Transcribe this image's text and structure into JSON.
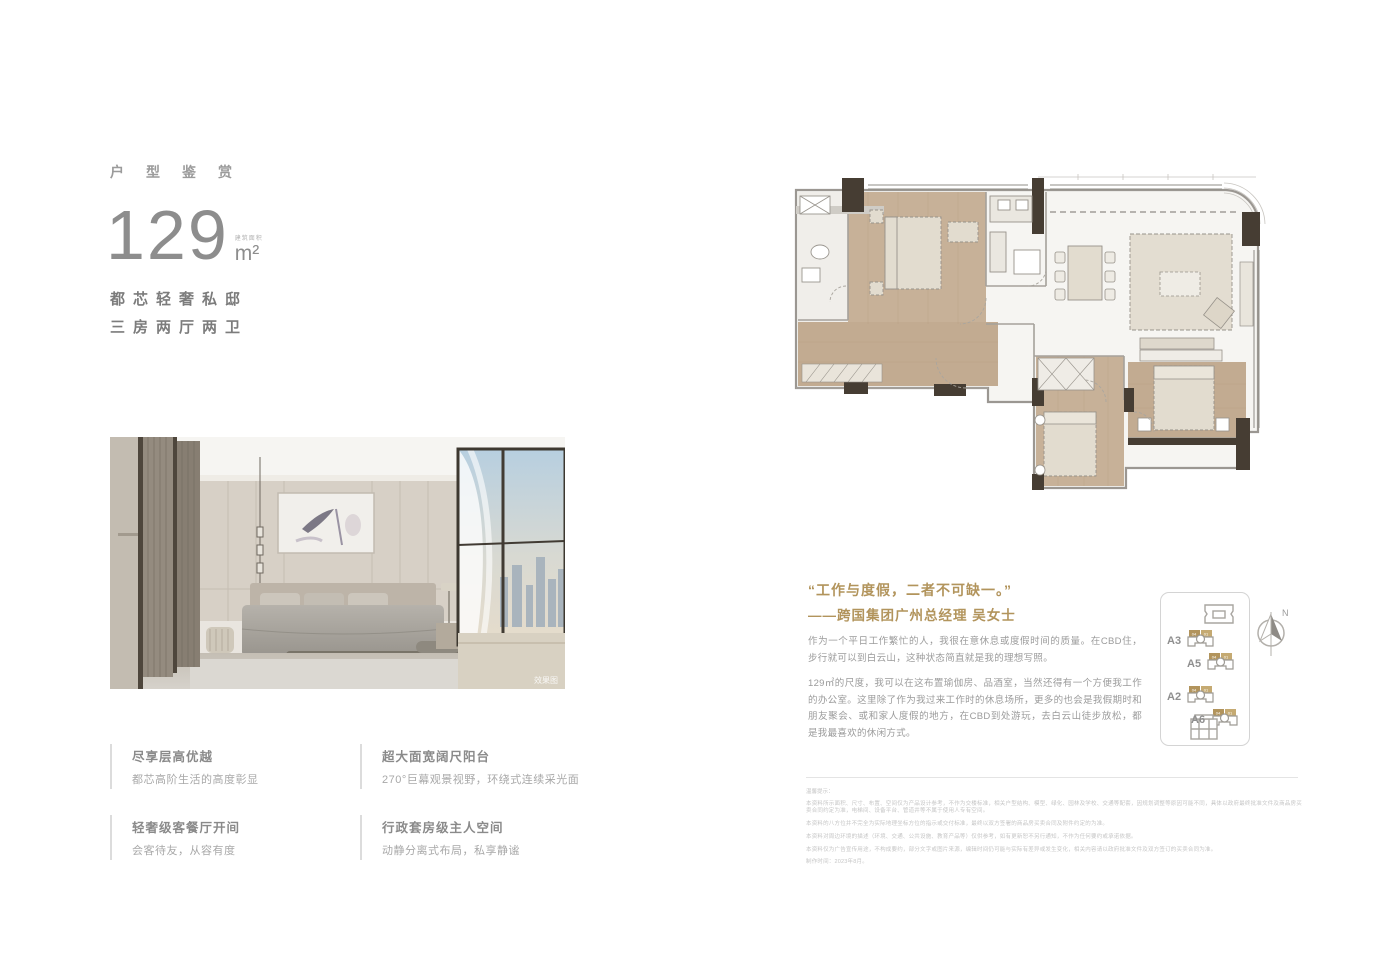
{
  "colors": {
    "gold": "#b2945c",
    "heading_gray": "#7c7c7c",
    "body_gray": "#9b9b9b",
    "disclaimer_gray": "#c6c6c6",
    "wood_floor": "#c7b198",
    "wall_dark": "#463d33"
  },
  "header": {
    "eyebrow": "户型鉴赏"
  },
  "area": {
    "number": "129",
    "label": "建筑面积",
    "unit": "m²"
  },
  "taglines": {
    "line1": "都芯轻奢私邸",
    "line2": "三房两厅两卫"
  },
  "photo": {
    "watermark": "效果图"
  },
  "features": [
    {
      "title": "尽享层高优越",
      "desc": "都芯高阶生活的高度彰显"
    },
    {
      "title": "超大面宽阔尺阳台",
      "desc": "270°巨幕观景视野，环绕式连续采光面"
    },
    {
      "title": "轻奢级客餐厅开间",
      "desc": "会客待友，从容有度"
    },
    {
      "title": "行政套房级主人空间",
      "desc": "动静分离式布局，私享静谧"
    }
  ],
  "quote": {
    "line1": "“工作与度假，二者不可缺一。”",
    "line2": "——跨国集团广州总经理 吴女士"
  },
  "paragraphs": {
    "p1": "作为一个平日工作繁忙的人，我很在意休息或度假时间的质量。在CBD住，步行就可以到白云山，这种状态简直就是我的理想写照。",
    "p2": "129㎡的尺度，我可以在这布置瑜伽房、品酒室，当然还得有一个方便我工作的办公室。这里除了作为我过来工作时的休息场所，更多的也会是我假期时和朋友聚会、或和家人度假的地方，在CBD到处游玩，去白云山徒步放松，都是我最喜欢的休闲方式。"
  },
  "siteplan": {
    "units": [
      "A3",
      "A5",
      "A2",
      "A6"
    ],
    "unit_tags": [
      "04",
      "01"
    ],
    "compass": "N"
  },
  "disclaimer": {
    "title": "温馨提示：",
    "lines": [
      "本资料所示面积、尺寸、布置、空间仅为产品设计参考，不作为交楼标准，相关户型结构、模型、绿化、园林及学校、交通等配套，因规划调整等原因可能不同，具体以政府最终批准文件及商品房买卖合同约定为准，电梯间、设备平台、管道井等不属于使用人专有空间。",
      "本资料的八方位并不完全为实际地理坐标方位的指示或交付标准，最终以双方签署的商品房买卖合同及附件约定的为准。",
      "本资料对周边环境的描述（环境、交通、公共设施、教育产品等）仅供参考，如有更新恕不另行通知，不作为任何要约或承诺依据。",
      "本资料仅为广告宣传用途，不构成要约，部分文字或图片来源，编辑时间仍可能与实际有差异或发生变化，相关内容请以政府批准文件及双方签订的买卖合同为准。",
      "制作时间：2023年8月。"
    ]
  }
}
